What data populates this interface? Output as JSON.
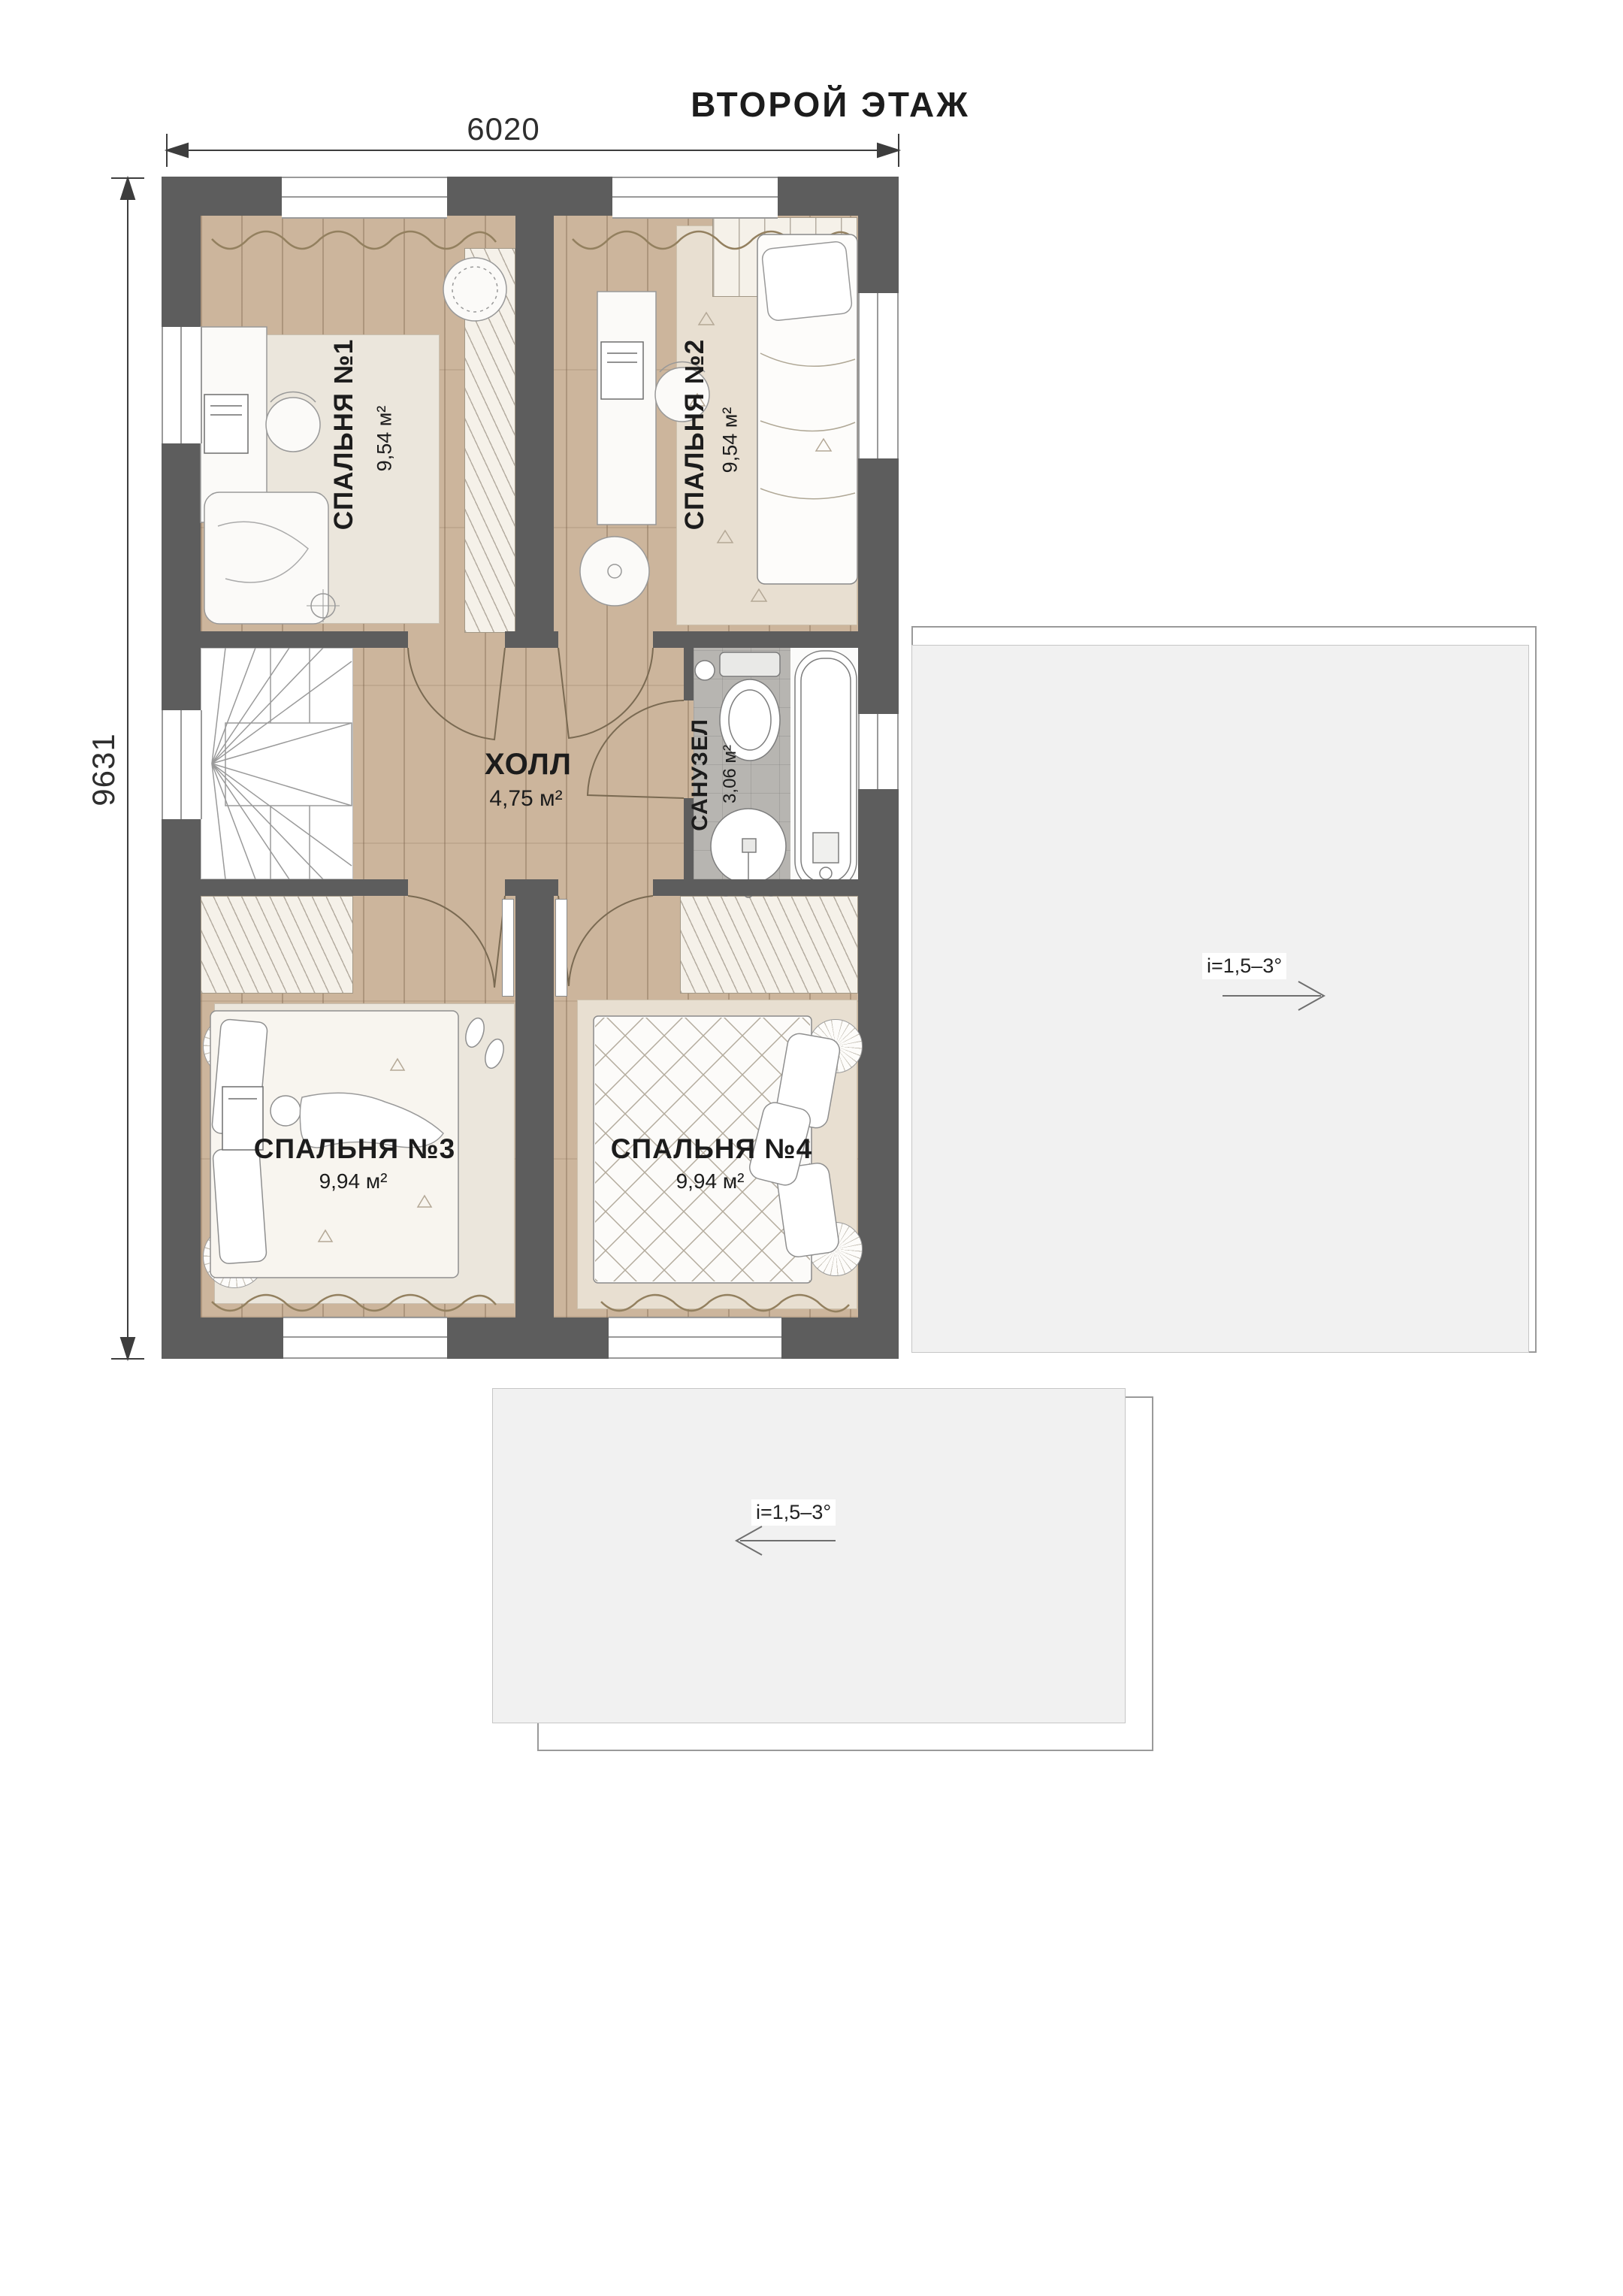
{
  "title": "ВТОРОЙ ЭТАЖ",
  "dimensions": {
    "top": "6020",
    "left": "9631"
  },
  "rooms": {
    "bedroom1": {
      "name": "СПАЛЬНЯ №1",
      "area": "9,54 м²"
    },
    "bedroom2": {
      "name": "СПАЛЬНЯ №2",
      "area": "9,54 м²"
    },
    "hall": {
      "name": "ХОЛЛ",
      "area": "4,75 м²"
    },
    "bathroom": {
      "name": "САНУЗЕЛ",
      "area": "3,06 м²"
    },
    "bedroom3": {
      "name": "СПАЛЬНЯ №3",
      "area": "9,94 м²"
    },
    "bedroom4": {
      "name": "СПАЛЬНЯ №4",
      "area": "9,94 м²"
    }
  },
  "roof": {
    "right_slope": "i=1,5–3°",
    "bottom_slope": "i=1,5–3°"
  },
  "colors": {
    "wall": "#5d5d5d",
    "wood_floor": "#ccb59c",
    "bath_tile": "#b7b5b1",
    "roof_fill": "#f1f1f1",
    "rug": "#ebe6dc"
  }
}
